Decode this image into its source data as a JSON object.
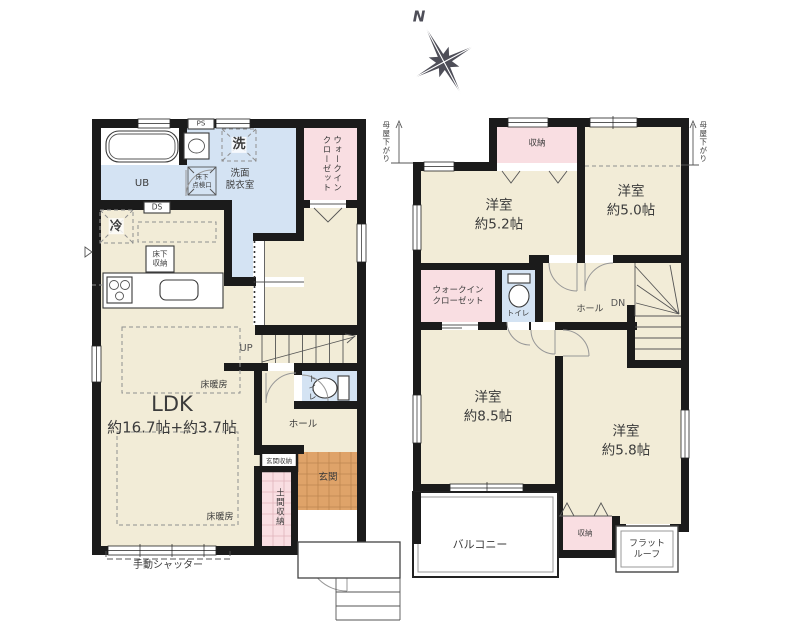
{
  "compass": {
    "north": "N"
  },
  "floor1": {
    "ps": "PS",
    "laundry": "洗",
    "washroom": "洗面\n脱衣室",
    "ub": "UB",
    "inspection_hatch": "床下\n点検口",
    "walk_in_closet": "ウォークイン\nクローゼット",
    "ds": "DS",
    "fridge": "冷",
    "underfloor_storage": "床下\n収納",
    "floor_heating": "床暖房",
    "ldk": "LDK",
    "ldk_size": "約16.7帖+約3.7帖",
    "up": "UP",
    "toilet": "トイレ",
    "hall": "ホール",
    "entrance_storage": "玄関収納",
    "entrance": "玄関",
    "doma_storage": "土間収納",
    "shutter": "手動シャッター"
  },
  "floor2": {
    "moya_sagari_left": "母屋下がり",
    "moya_sagari_right": "母屋下がり",
    "closet_top": "収納",
    "room52": "洋室",
    "room52_size": "約5.2帖",
    "room50": "洋室",
    "room50_size": "約5.0帖",
    "walk_in_closet": "ウォークイン\nクローゼット",
    "toilet": "トイレ",
    "hall": "ホール",
    "dn": "DN",
    "room85": "洋室",
    "room85_size": "約8.5帖",
    "room58": "洋室",
    "room58_size": "約5.8帖",
    "balcony": "バルコニー",
    "closet_bottom": "収納",
    "flat_roof": "フラット\nルーフ"
  },
  "colors": {
    "wall": "#1b1b1b",
    "room": "#f2ecd7",
    "wet": "#d4e3f3",
    "closet": "#f9dee2",
    "tile": "#dfa369",
    "compass": "#4e4e58"
  }
}
